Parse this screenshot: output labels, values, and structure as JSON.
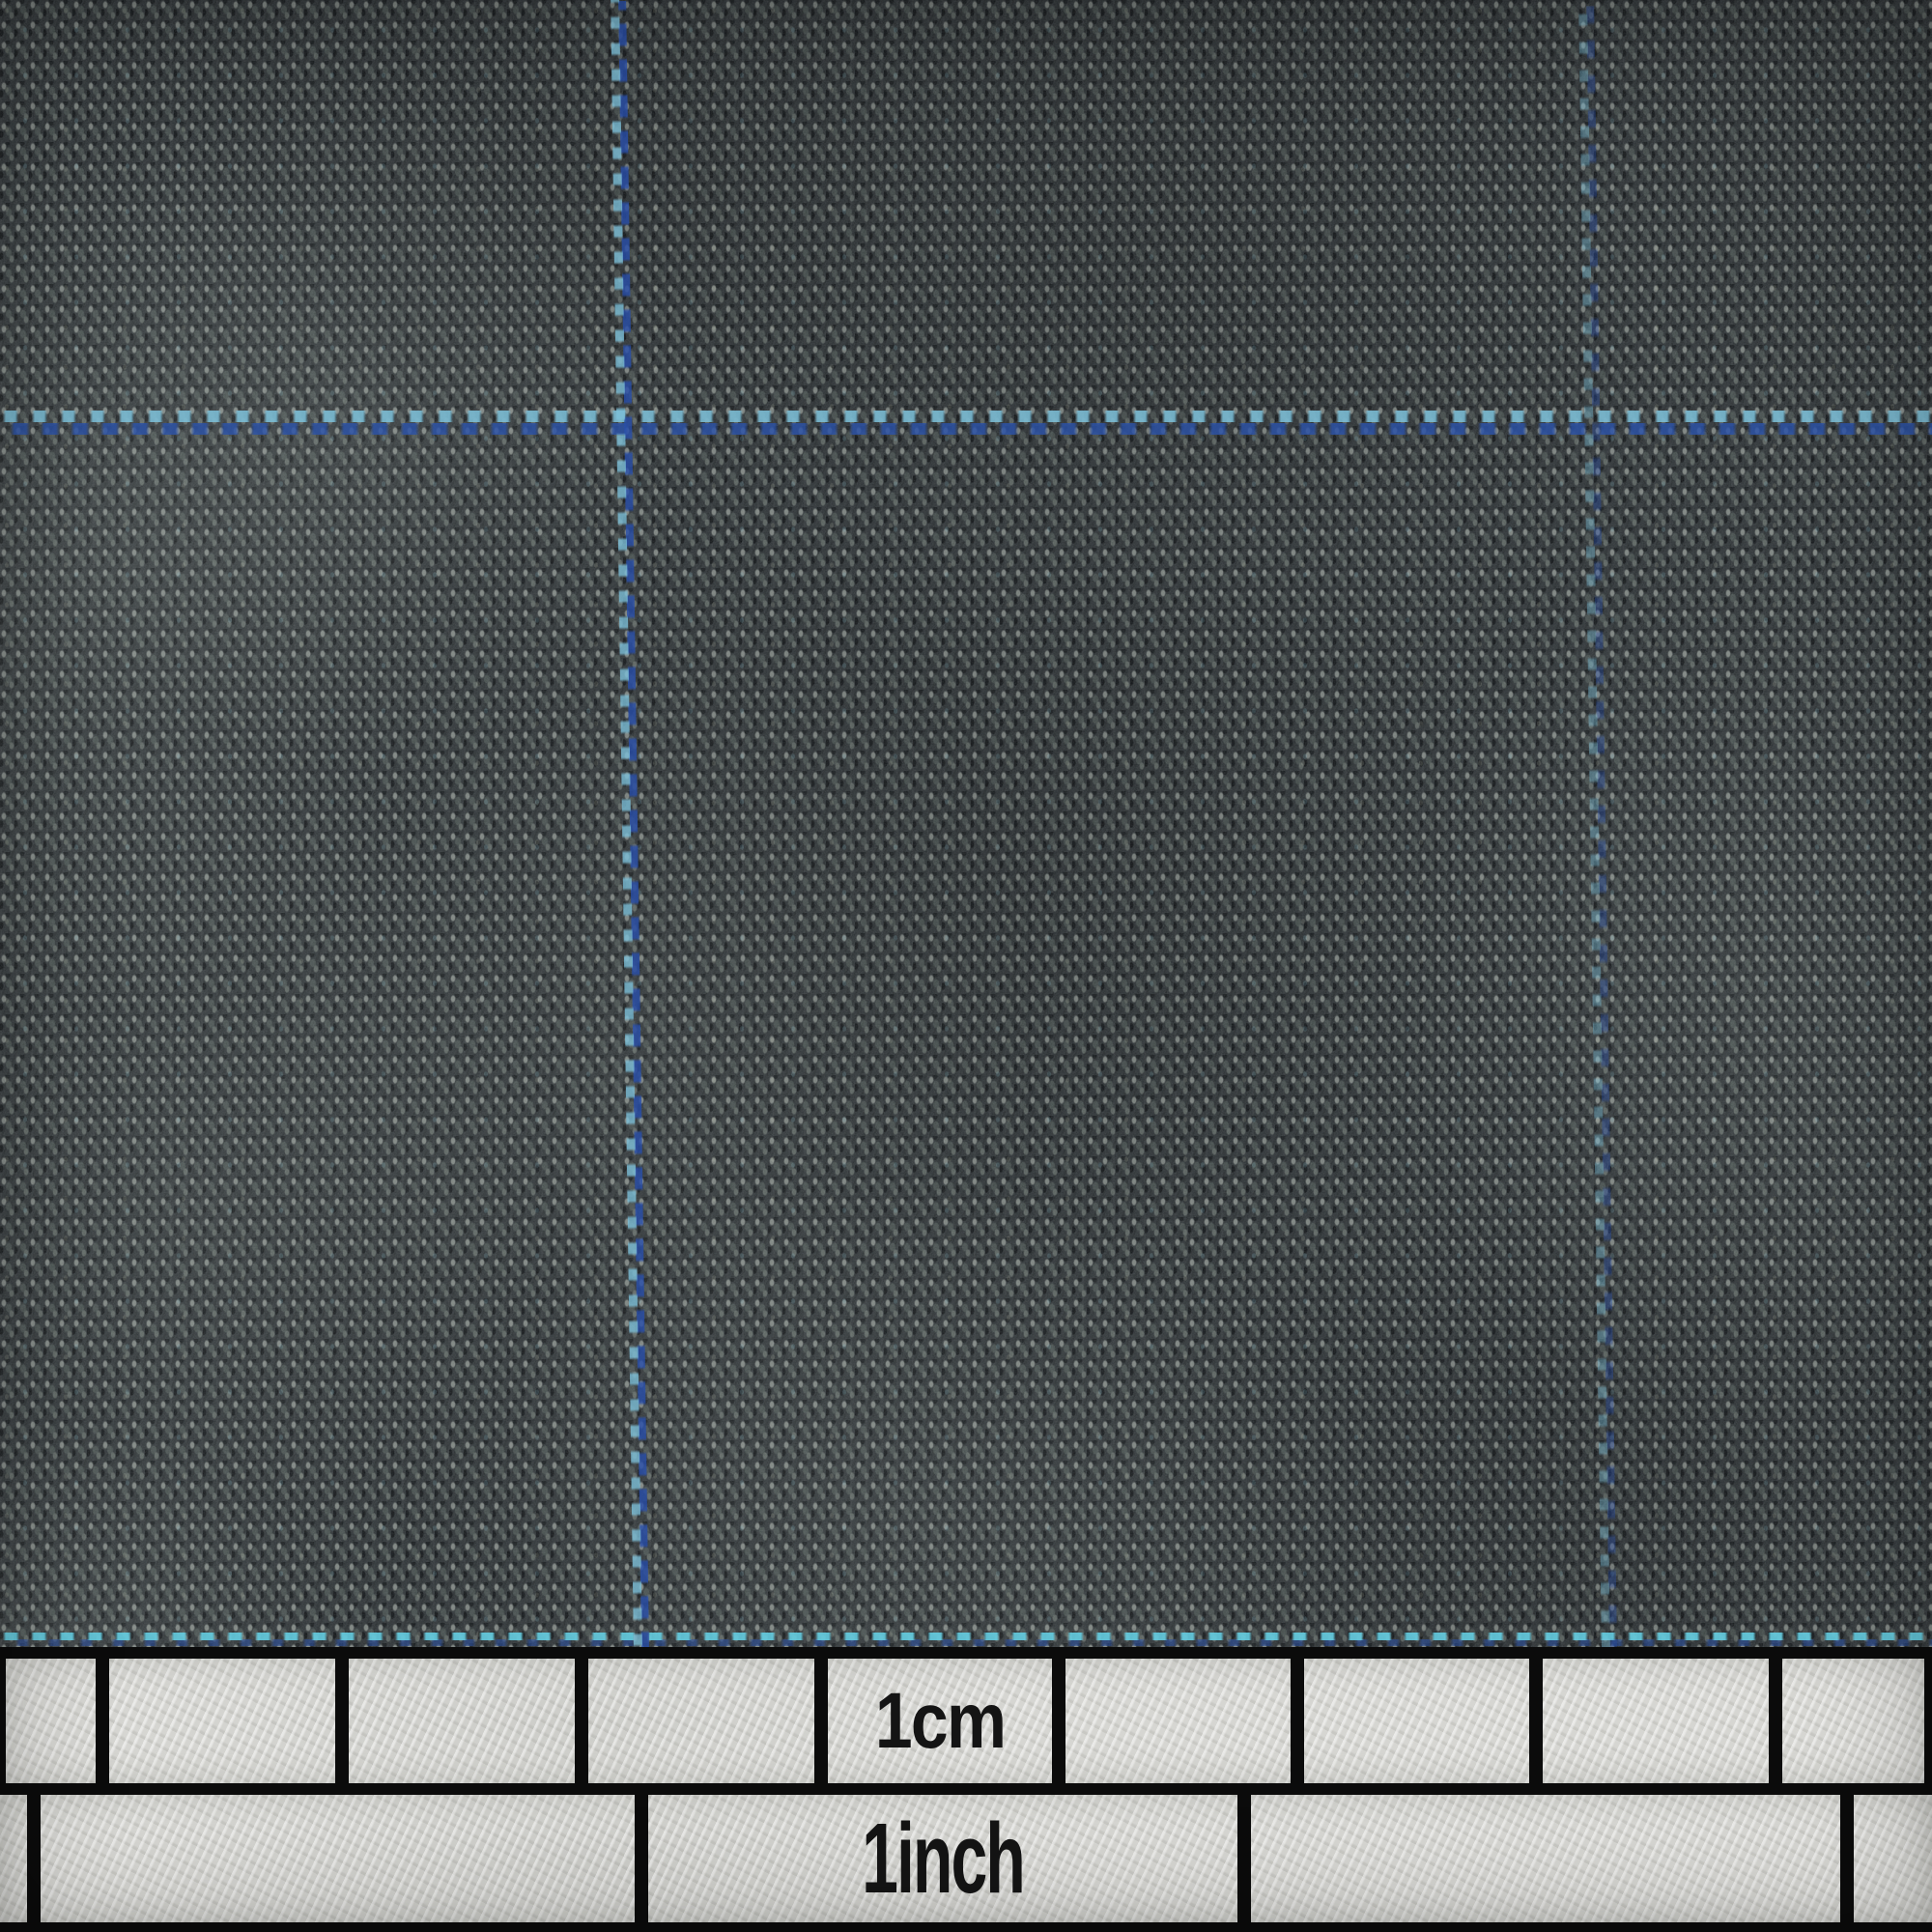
{
  "scene": {
    "subject": "Macro photograph of dark charcoal grey woven suiting fabric with a light blue windowpane overcheck",
    "overlay": "Semi-transparent measurement scale bar across the bottom edge with centimetre and inch cells"
  },
  "ruler": {
    "cm_label": "1cm",
    "inch_label": "1inch"
  },
  "colors": {
    "fabric_base": "#2e3336",
    "fabric_fleck_light": "#cdd5cb",
    "fabric_fleck_mid": "#8a968e",
    "overcheck_sky_blue": "#6db9d8",
    "overcheck_royal_blue": "#2d55a8",
    "ruler_cell": "#d6d6d2",
    "ruler_line": "#0b0b0b",
    "label_text": "#141414"
  }
}
